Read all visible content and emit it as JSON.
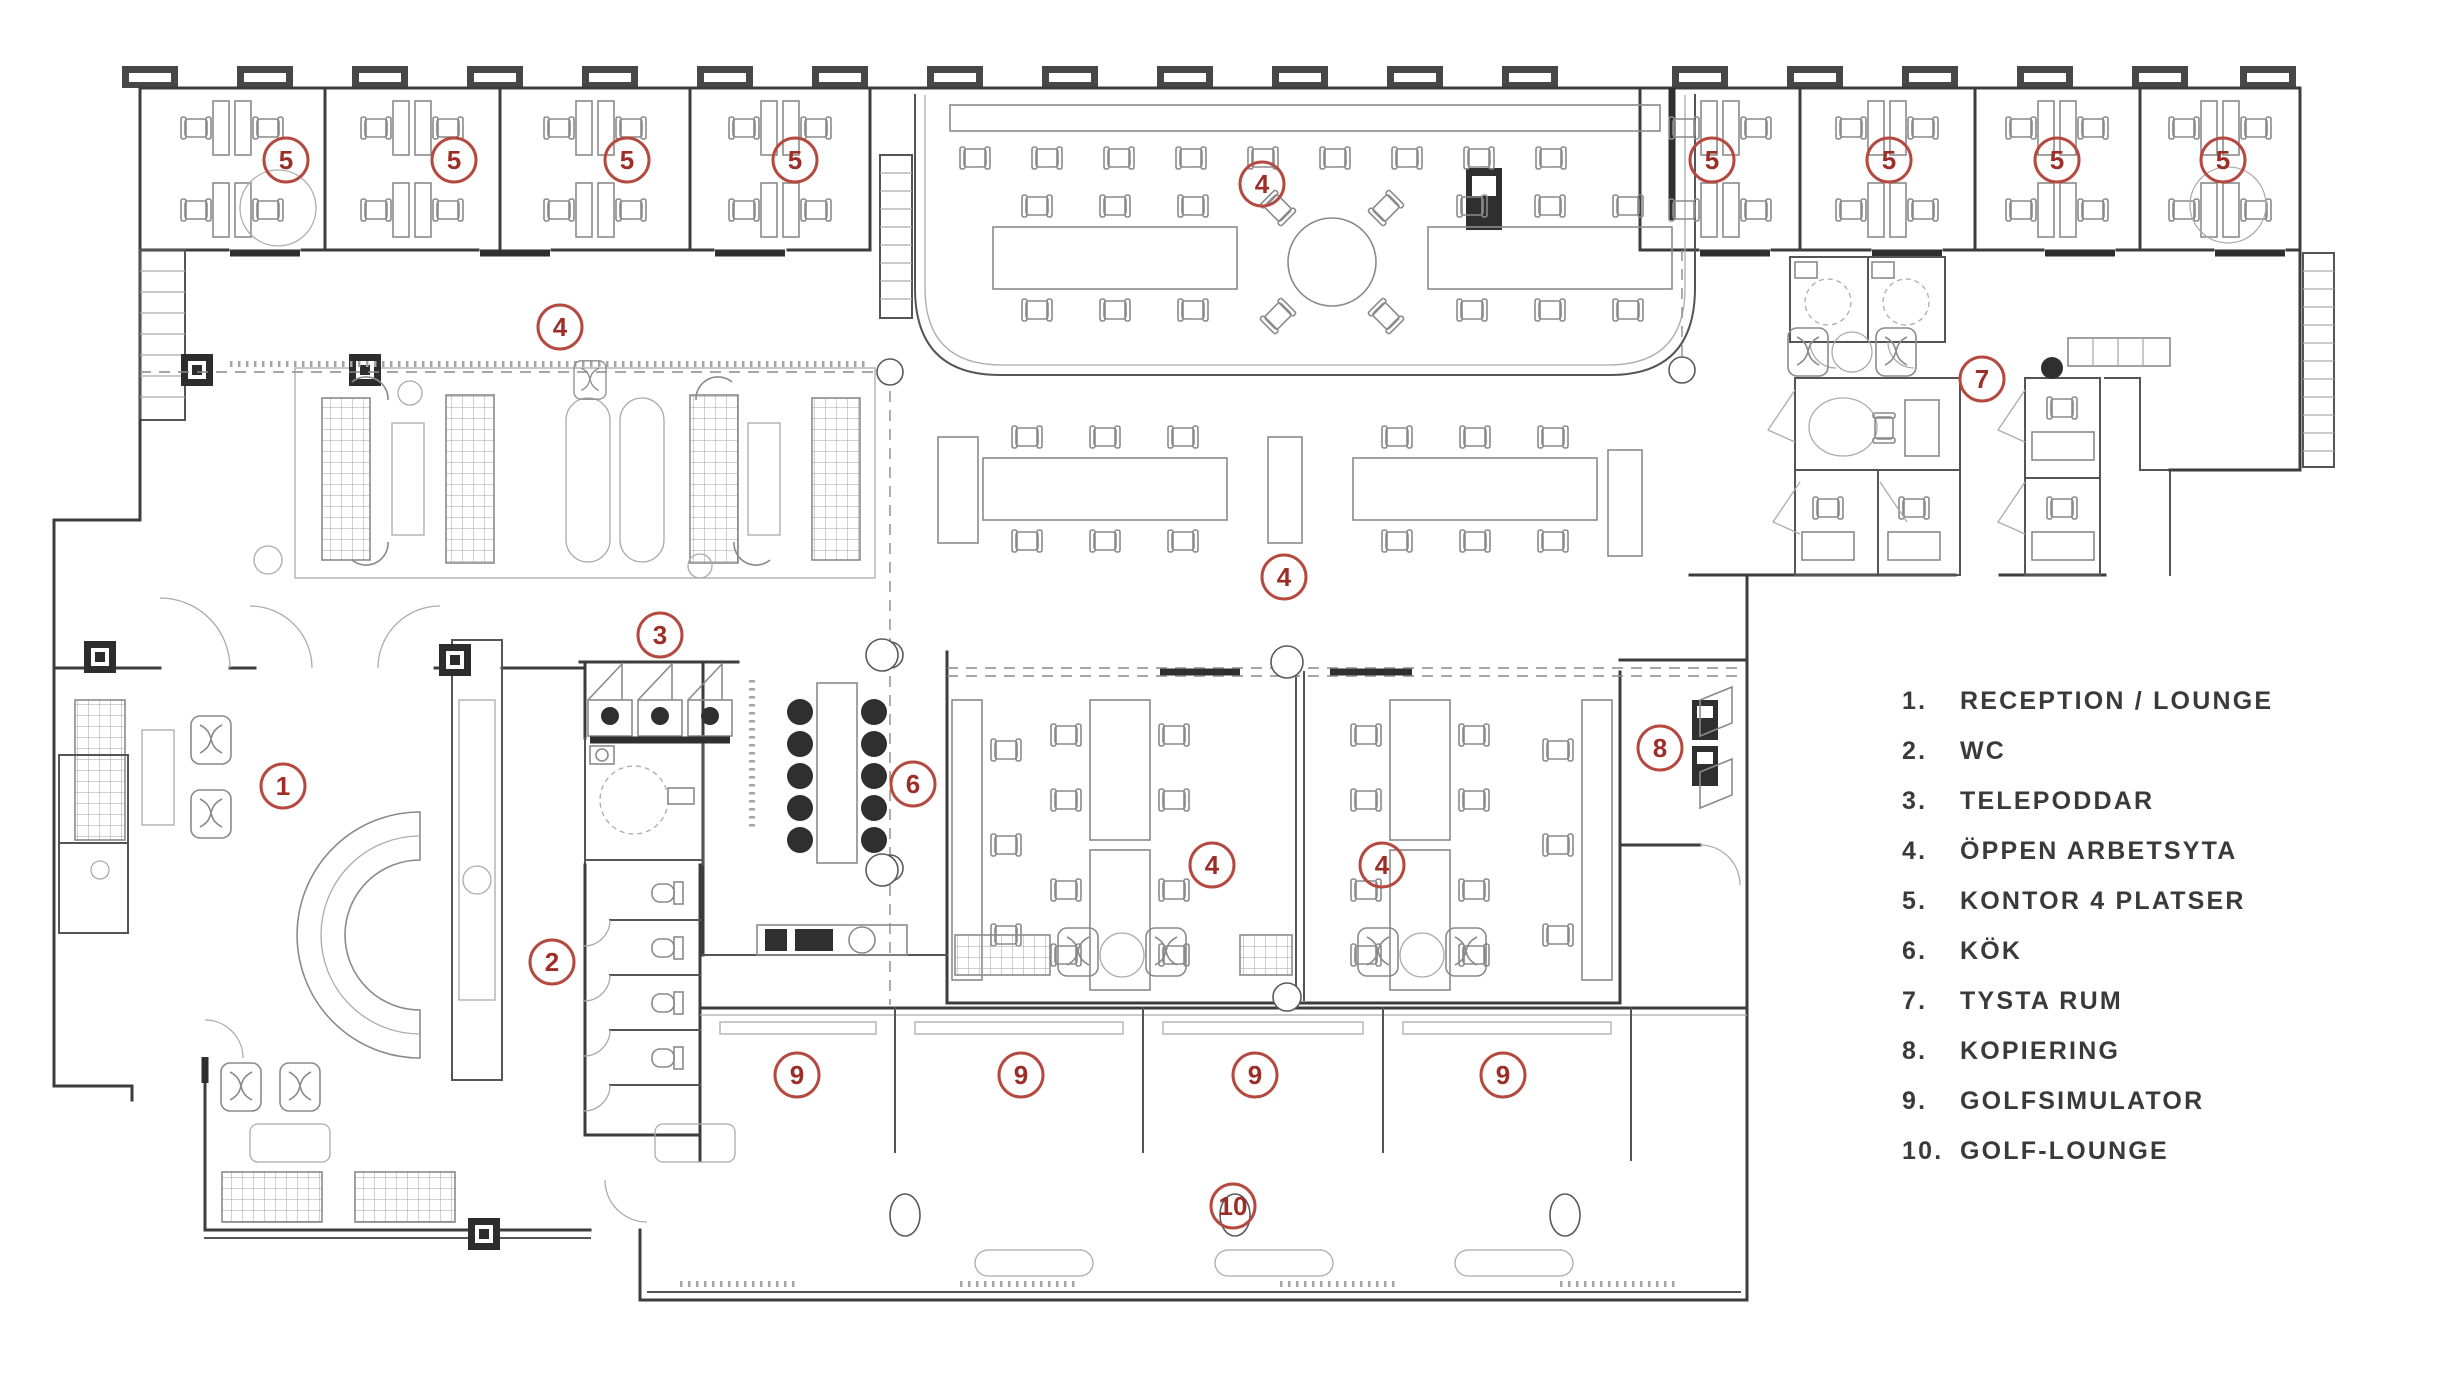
{
  "palette": {
    "marker_stroke": "#b5493f",
    "marker_number": "#9c2e27",
    "legend_text": "#3a3a3a",
    "wall": "#3c3c3c",
    "furniture": "#8a8a8a",
    "background": "#ffffff"
  },
  "legend": {
    "items": [
      {
        "num": "1.",
        "label": "RECEPTION / LOUNGE"
      },
      {
        "num": "2.",
        "label": "WC"
      },
      {
        "num": "3.",
        "label": "TELEPODDAR"
      },
      {
        "num": "4.",
        "label": "ÖPPEN ARBETSYTA"
      },
      {
        "num": "5.",
        "label": "KONTOR 4 PLATSER"
      },
      {
        "num": "6.",
        "label": "KÖK"
      },
      {
        "num": "7.",
        "label": "TYSTA RUM"
      },
      {
        "num": "8.",
        "label": "KOPIERING"
      },
      {
        "num": "9.",
        "label": "GOLFSIMULATOR"
      },
      {
        "num": "10.",
        "label": "GOLF-LOUNGE"
      }
    ]
  },
  "floorplan": {
    "markers": [
      {
        "label": "1",
        "x": 283,
        "y": 786
      },
      {
        "label": "2",
        "x": 552,
        "y": 962
      },
      {
        "label": "3",
        "x": 660,
        "y": 635
      },
      {
        "label": "4",
        "x": 560,
        "y": 327
      },
      {
        "label": "4",
        "x": 1262,
        "y": 184
      },
      {
        "label": "4",
        "x": 1284,
        "y": 577
      },
      {
        "label": "4",
        "x": 1212,
        "y": 865
      },
      {
        "label": "4",
        "x": 1382,
        "y": 865
      },
      {
        "label": "5",
        "x": 286,
        "y": 160
      },
      {
        "label": "5",
        "x": 454,
        "y": 160
      },
      {
        "label": "5",
        "x": 627,
        "y": 160
      },
      {
        "label": "5",
        "x": 795,
        "y": 160
      },
      {
        "label": "5",
        "x": 1712,
        "y": 160
      },
      {
        "label": "5",
        "x": 1889,
        "y": 160
      },
      {
        "label": "5",
        "x": 2057,
        "y": 160
      },
      {
        "label": "5",
        "x": 2223,
        "y": 160
      },
      {
        "label": "6",
        "x": 913,
        "y": 784
      },
      {
        "label": "7",
        "x": 1982,
        "y": 379
      },
      {
        "label": "8",
        "x": 1660,
        "y": 748
      },
      {
        "label": "9",
        "x": 797,
        "y": 1075
      },
      {
        "label": "9",
        "x": 1021,
        "y": 1075
      },
      {
        "label": "9",
        "x": 1255,
        "y": 1075
      },
      {
        "label": "9",
        "x": 1503,
        "y": 1075
      },
      {
        "label": "10",
        "x": 1233,
        "y": 1206
      }
    ]
  }
}
